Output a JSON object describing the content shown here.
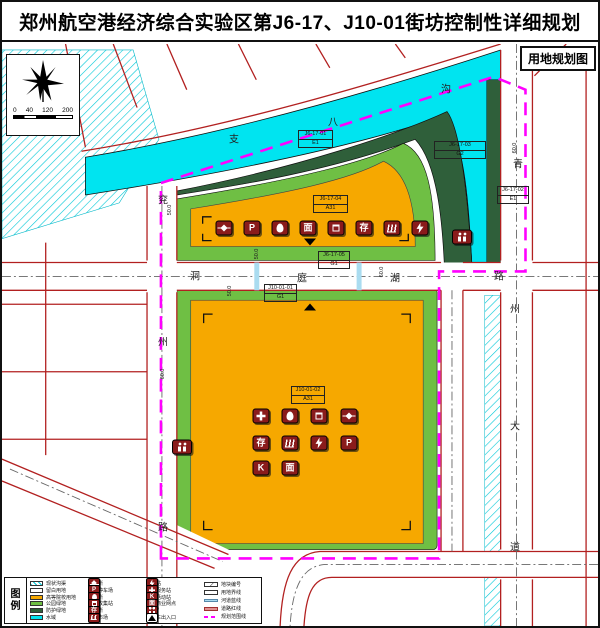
{
  "title": "郑州航空港经济综合实验区第J6-17、J10-01街坊控制性详细规划",
  "map_label": "用地规划图",
  "scalebar": {
    "ticks": [
      "0",
      "40",
      "120",
      "200"
    ]
  },
  "colors": {
    "water": "#00E4F0",
    "dkgreen": "#2F5F3A",
    "green": "#6FBF44",
    "orange": "#F6A800",
    "magenta": "#FF00FF",
    "roadred": "#B22020",
    "iconred": "#8A1B1B",
    "hatch": "#00C8D8",
    "blueline": "#AADCF0"
  },
  "road_names": [
    {
      "name": "洞庭湖路",
      "chars": [
        [
          "洞",
          193,
          231
        ],
        [
          "庭",
          300,
          233
        ],
        [
          "湖",
          393,
          233
        ],
        [
          "路",
          497,
          231
        ]
      ]
    },
    {
      "name": "兖州路",
      "chars": [
        [
          "兖",
          161,
          155
        ],
        [
          "州",
          161,
          297
        ],
        [
          "路",
          161,
          482
        ]
      ]
    },
    {
      "name": "青州大道",
      "chars": [
        [
          "青",
          516,
          119
        ],
        [
          "州",
          513,
          264
        ],
        [
          "大",
          513,
          381
        ],
        [
          "道",
          513,
          502
        ]
      ]
    },
    {
      "name": "支八沟",
      "chars": [
        [
          "支",
          232,
          94
        ],
        [
          "八",
          331,
          77
        ],
        [
          "沟",
          444,
          44
        ]
      ]
    }
  ],
  "parcels": [
    {
      "code": "J6-17-01",
      "use": "E1",
      "x": 296,
      "y": 86,
      "w": 35
    },
    {
      "code": "J6-17-03",
      "use": "G2",
      "x": 432,
      "y": 97,
      "w": 52
    },
    {
      "code": "J6-17-02",
      "use": "E1",
      "x": 495,
      "y": 142,
      "w": 32
    },
    {
      "code": "J6-17-04",
      "use": "A31",
      "x": 311,
      "y": 151,
      "w": 35
    },
    {
      "code": "J6-17-05",
      "use": "G1",
      "x": 316,
      "y": 207,
      "w": 32
    },
    {
      "code": "J10-01-01",
      "use": "G1",
      "x": 262,
      "y": 240,
      "w": 33
    },
    {
      "code": "J10-01-02",
      "use": "A31",
      "x": 289,
      "y": 342,
      "w": 34
    }
  ],
  "dimensions": [
    [
      "50.0",
      168,
      166
    ],
    [
      "50.0",
      255,
      210
    ],
    [
      "50.0",
      228,
      247
    ],
    [
      "60.0",
      380,
      228
    ],
    [
      "60.0",
      513,
      104
    ],
    [
      "60.0",
      161,
      330
    ]
  ],
  "entrances": [
    [
      308,
      198,
      "down"
    ],
    [
      308,
      263,
      "up"
    ]
  ],
  "icon_defs": {
    "P": {
      "glyph": "P"
    },
    "K": {
      "glyph": "K"
    },
    "cun": {
      "glyph": "存"
    },
    "mian": {
      "glyph": "面"
    },
    "switch": {
      "shape": "switch"
    },
    "drop": {
      "shape": "drop"
    },
    "trash": {
      "shape": "trash"
    },
    "basket": {
      "shape": "basket"
    },
    "bolt": {
      "shape": "bolt"
    },
    "plus": {
      "shape": "plus"
    },
    "people": {
      "shape": "people"
    },
    "tri": {
      "shape": "tri"
    }
  },
  "facilities": {
    "upper_row": [
      [
        222,
        184,
        "switch"
      ],
      [
        250,
        184,
        "P"
      ],
      [
        278,
        184,
        "drop"
      ],
      [
        306,
        184,
        "mian"
      ],
      [
        334,
        184,
        "trash"
      ],
      [
        362,
        184,
        "cun"
      ],
      [
        390,
        184,
        "basket"
      ],
      [
        418,
        184,
        "bolt"
      ]
    ],
    "lower_block": [
      [
        259,
        372,
        "plus"
      ],
      [
        288,
        372,
        "drop"
      ],
      [
        317,
        372,
        "trash"
      ],
      [
        347,
        372,
        "switch"
      ],
      [
        259,
        399,
        "cun"
      ],
      [
        288,
        399,
        "basket"
      ],
      [
        317,
        399,
        "bolt"
      ],
      [
        347,
        399,
        "P"
      ],
      [
        259,
        424,
        "K"
      ],
      [
        288,
        424,
        "mian"
      ]
    ],
    "toilets": [
      [
        460,
        193
      ],
      [
        180,
        403
      ]
    ]
  },
  "legend": {
    "title": "图例",
    "col1": [
      {
        "sw": "hatch",
        "label": "现状沟渠"
      },
      {
        "sw": "white",
        "label": "留白用地"
      },
      {
        "sw": "orange",
        "label": "高等院校用地"
      },
      {
        "sw": "green",
        "label": "公园绿地"
      },
      {
        "sw": "dkgreen",
        "label": "防护绿地"
      },
      {
        "sw": "cyan",
        "label": "水域"
      }
    ],
    "col2": [
      {
        "icon": "switch",
        "label": "开闭所"
      },
      {
        "icon": "P",
        "label": "公共停车场"
      },
      {
        "icon": "drop",
        "label": "邮政所"
      },
      {
        "icon": "trash",
        "label": "垃圾收集站"
      },
      {
        "icon": "cun",
        "label": "储蓄所"
      },
      {
        "icon": "basket",
        "label": "肉菜市场"
      }
    ],
    "col3": [
      {
        "icon": "bolt",
        "label": "变电站"
      },
      {
        "icon": "plus",
        "label": "卫生服务站"
      },
      {
        "icon": "K",
        "label": "文化活动站"
      },
      {
        "icon": "mian",
        "label": "社区商业网点"
      },
      {
        "icon": "people",
        "label": "公厕"
      },
      {
        "icon": "tri",
        "label": "机动车出入口"
      }
    ],
    "col4": [
      {
        "sym": "tag",
        "label": "地块编号"
      },
      {
        "sym": "rect",
        "label": "用地界线"
      },
      {
        "sym": "blueline",
        "label": "河道蓝线"
      },
      {
        "sym": "redband",
        "label": "道路红线"
      },
      {
        "sym": "magenta",
        "label": "规划范围线"
      }
    ]
  }
}
